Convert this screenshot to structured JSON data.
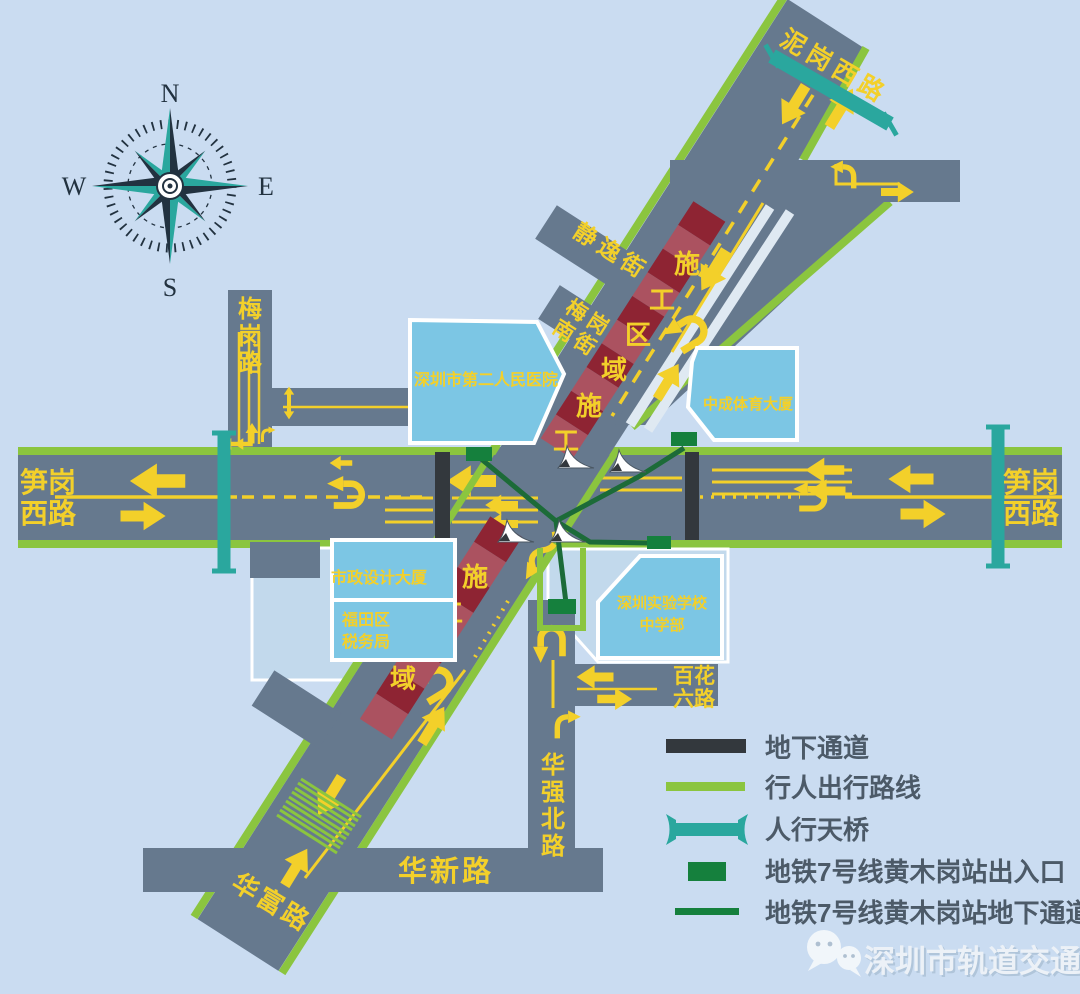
{
  "colors": {
    "background": "#cadcf1",
    "road_gray": "#66798e",
    "pedestrian_route_green": "#8bc53f",
    "footbridge_teal": "#2aa79e",
    "metro_green": "#15803d",
    "metro_line_green": "#1c6b38",
    "underpass_dark": "#33383d",
    "construction_dark_red": "#8e2433",
    "construction_light_red": "#ab5260",
    "marking_yellow": "#f3d02a",
    "building_blue": "#7cc6e4",
    "plaza_blue": "#c2d9ec",
    "legend_text": "#4c5a68"
  },
  "compass": {
    "north": "N",
    "south": "S",
    "east": "E",
    "west": "W"
  },
  "roads": {
    "nigang_west": "泥岗西路",
    "sungang_west_line1": "笋岗",
    "sungang_west_line2": "西路",
    "meigang": "梅岗路",
    "jingyi": "静逸街",
    "meigang_south_line1": "梅岗",
    "meigang_south_line2": "南街",
    "huaqiang_north": "华强北路",
    "huaxin": "华新路",
    "huafu": "华富路",
    "baihua_line1": "百花",
    "baihua_line2": "六路"
  },
  "buildings": {
    "hospital": "深圳市第二人民医院",
    "zhongcheng_sports": "中成体育大厦",
    "municipal_design": "市政设计大厦",
    "futian_tax_line1": "福田区",
    "futian_tax_line2": "税务局",
    "shiyan_school_line1": "深圳实验学校",
    "shiyan_school_line2": "中学部"
  },
  "construction_zone": "施工区域",
  "legend": {
    "items": [
      {
        "symbol": "underpass-bar",
        "label": "地下通道"
      },
      {
        "symbol": "pedestrian-route-line",
        "label": "行人出行路线"
      },
      {
        "symbol": "footbridge",
        "label": "人行天桥"
      },
      {
        "symbol": "metro-exit",
        "label": "地铁7号线黄木岗站出入口"
      },
      {
        "symbol": "metro-underpass-line",
        "label": "地铁7号线黄木岗站地下通道"
      }
    ]
  },
  "watermark": "深圳市轨道交通"
}
